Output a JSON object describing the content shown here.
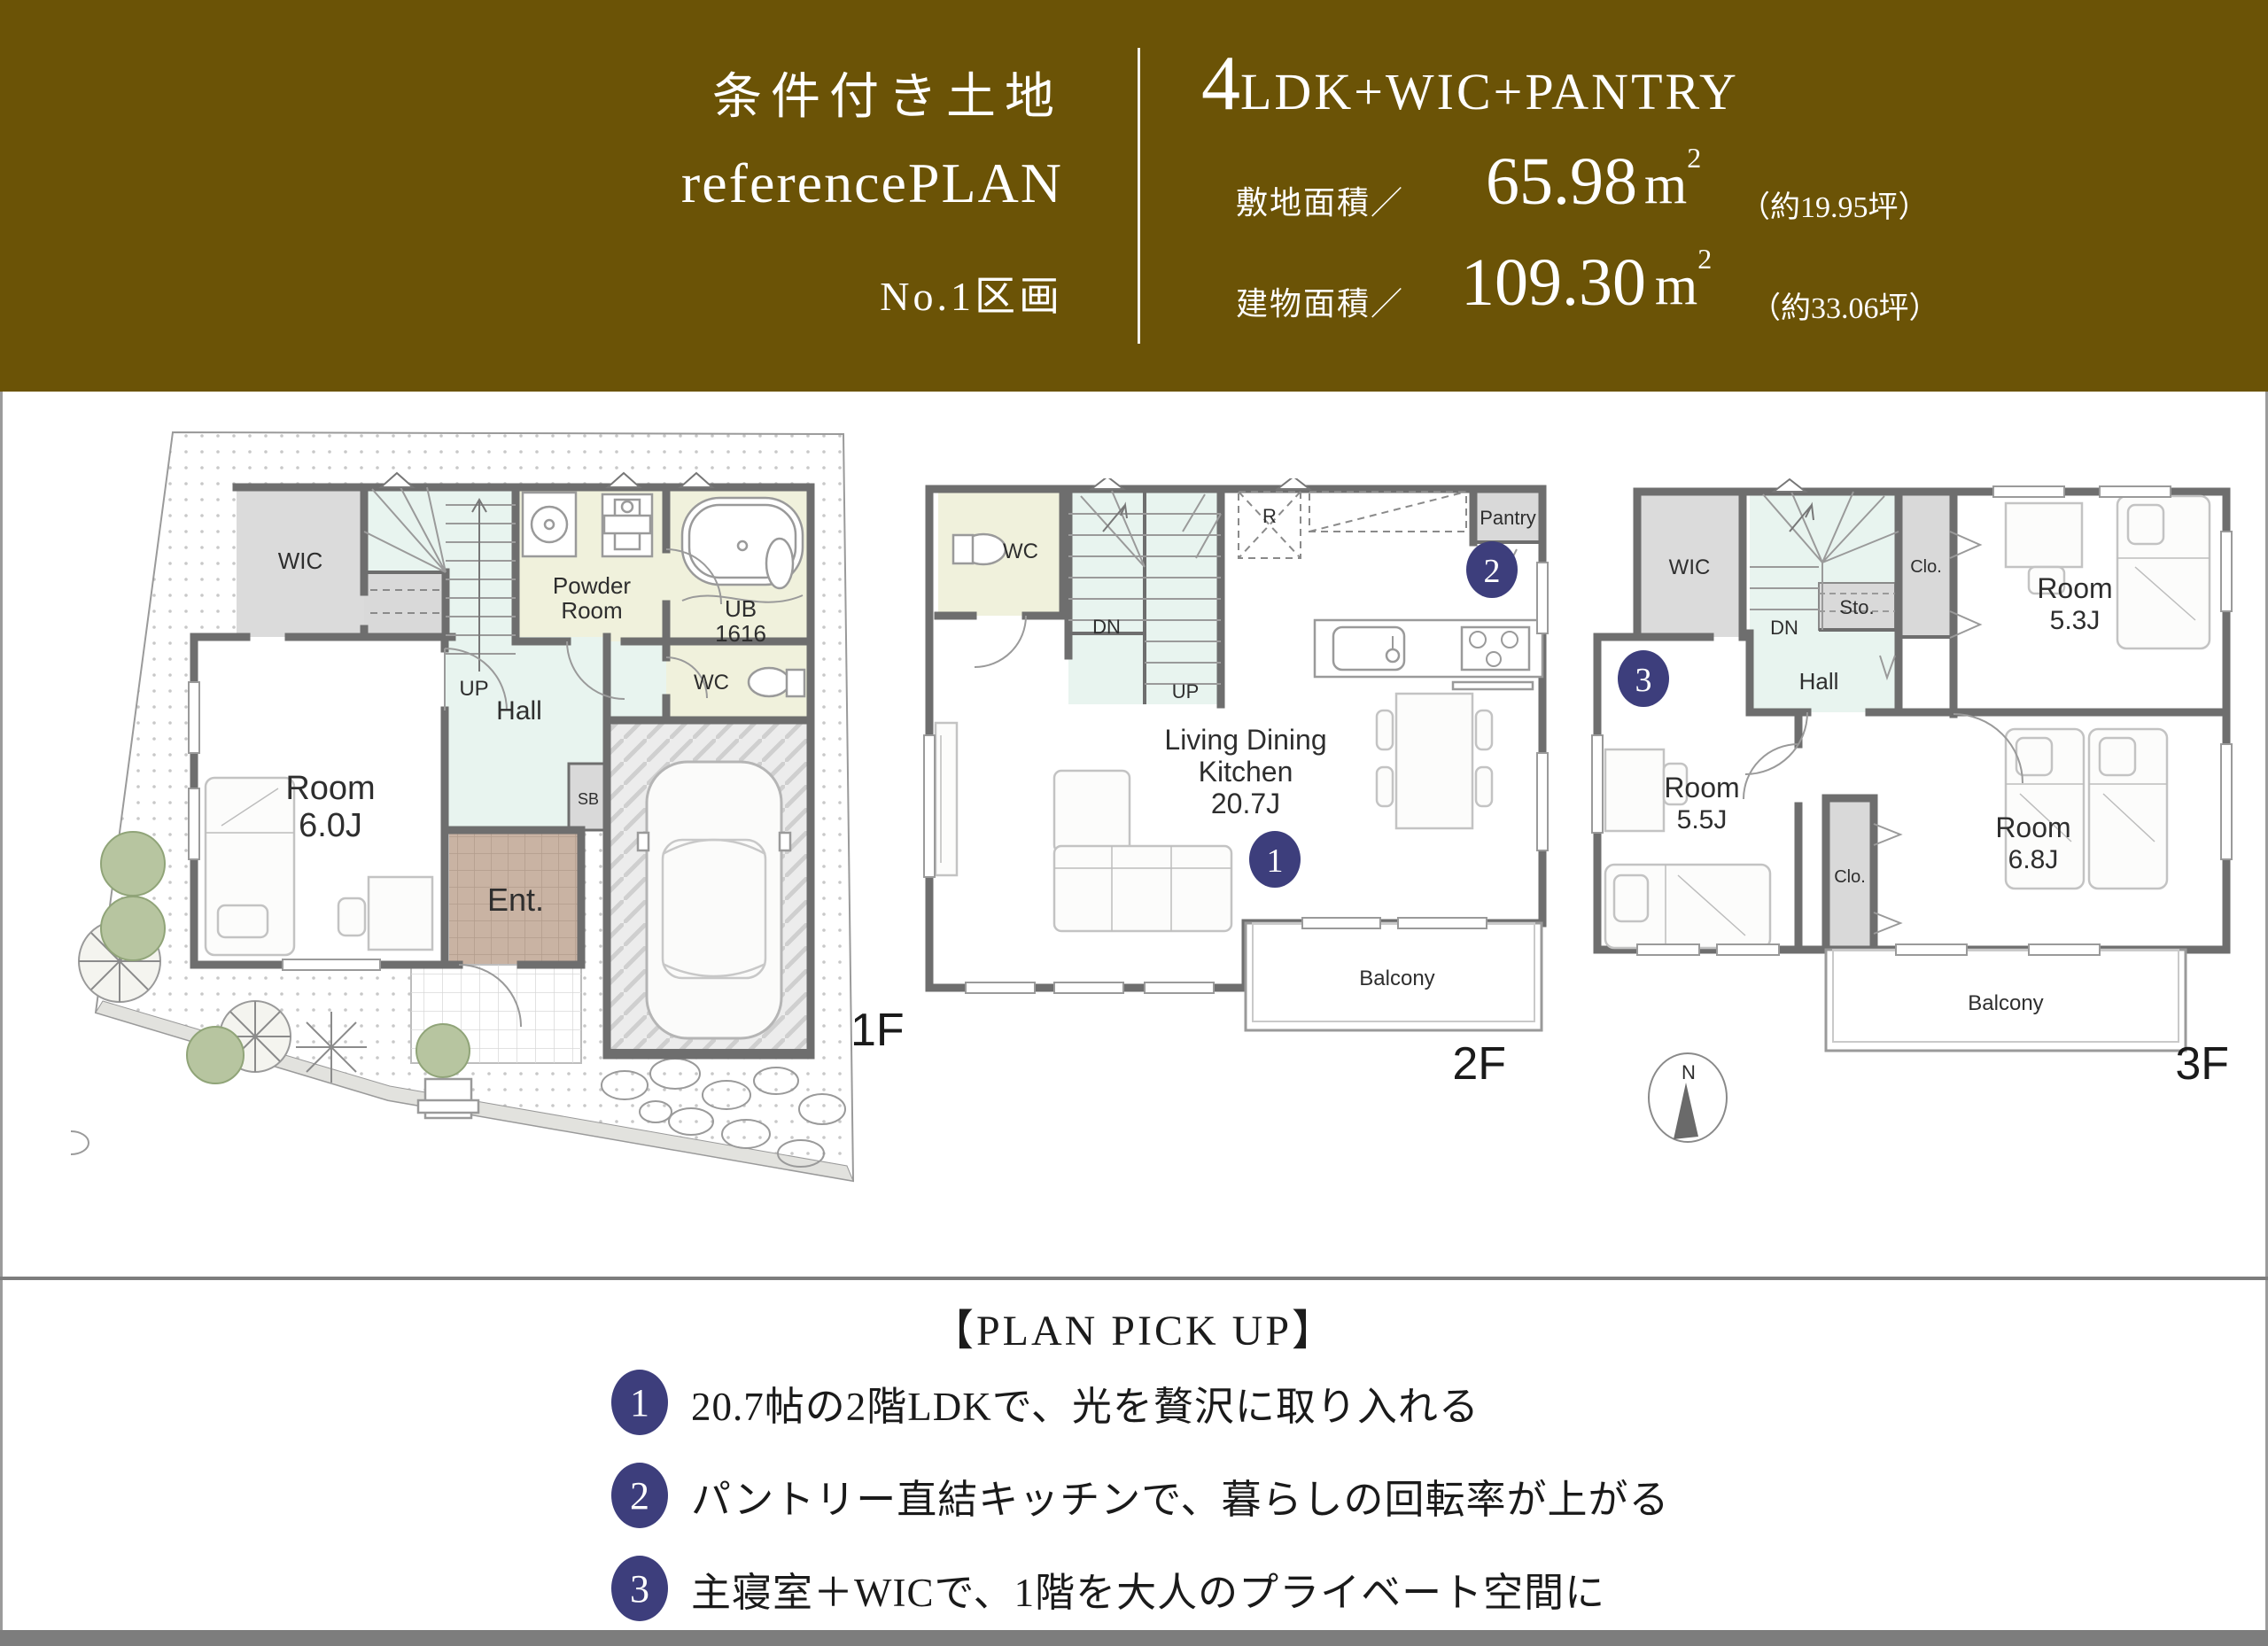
{
  "header": {
    "title_land": "条件付き土地",
    "title_plan": "referencePLAN",
    "title_lot": "No.1区画",
    "plan_type_lead": "4",
    "plan_type_rest": "LDK+WIC+PANTRY",
    "site_area_label": "敷地面積／",
    "site_area_value": "65.98",
    "site_area_unit": "m",
    "site_area_unit_sup": "2",
    "site_area_tsubo": "（約19.95坪）",
    "bldg_area_label": "建物面積／",
    "bldg_area_value": "109.30",
    "bldg_area_unit": "m",
    "bldg_area_unit_sup": "2",
    "bldg_area_tsubo": "（約33.06坪）"
  },
  "floor1": {
    "label": "1F",
    "wic": "WIC",
    "up": "UP",
    "powder_1": "Powder",
    "powder_2": "Room",
    "ub_1": "UB",
    "ub_2": "1616",
    "wc": "WC",
    "hall": "Hall",
    "sb": "SB",
    "room_1": "Room",
    "room_2": "6.0J",
    "ent": "Ent."
  },
  "floor2": {
    "label": "2F",
    "wc": "WC",
    "dn": "DN",
    "up": "UP",
    "r": "R",
    "pantry": "Pantry",
    "ldk_1": "Living Dining",
    "ldk_2": "Kitchen",
    "ldk_3": "20.7J",
    "balcony": "Balcony",
    "badge_1": "1",
    "badge_2": "2"
  },
  "floor3": {
    "label": "3F",
    "wic": "WIC",
    "dn": "DN",
    "sto": "Sto.",
    "clo_top": "Clo.",
    "room53_1": "Room",
    "room53_2": "5.3J",
    "hall": "Hall",
    "badge_3": "3",
    "room55_1": "Room",
    "room55_2": "5.5J",
    "clo_bottom": "Clo.",
    "room68_1": "Room",
    "room68_2": "6.8J",
    "balcony": "Balcony",
    "compass_n": "N"
  },
  "pickup": {
    "title": "【PLAN PICK UP】",
    "items": [
      {
        "num": "1",
        "text": "20.7帖の2階LDKで、光を贅沢に取り入れる"
      },
      {
        "num": "2",
        "text": "パントリー直結キッチンで、暮らしの回転率が上がる"
      },
      {
        "num": "3",
        "text": "主寝室＋WICで、1階を大人のプライベート空間に"
      }
    ]
  },
  "colors": {
    "header_bg": "#6b5306",
    "badge_navy": "#3d3e7c",
    "wall_gray": "#6e6e6e",
    "stair_mint": "#e8f4ef",
    "bath_cream": "#f0f1dc",
    "closet_gray": "#dbdbdb",
    "entrance_brown": "#c9b3a3"
  }
}
